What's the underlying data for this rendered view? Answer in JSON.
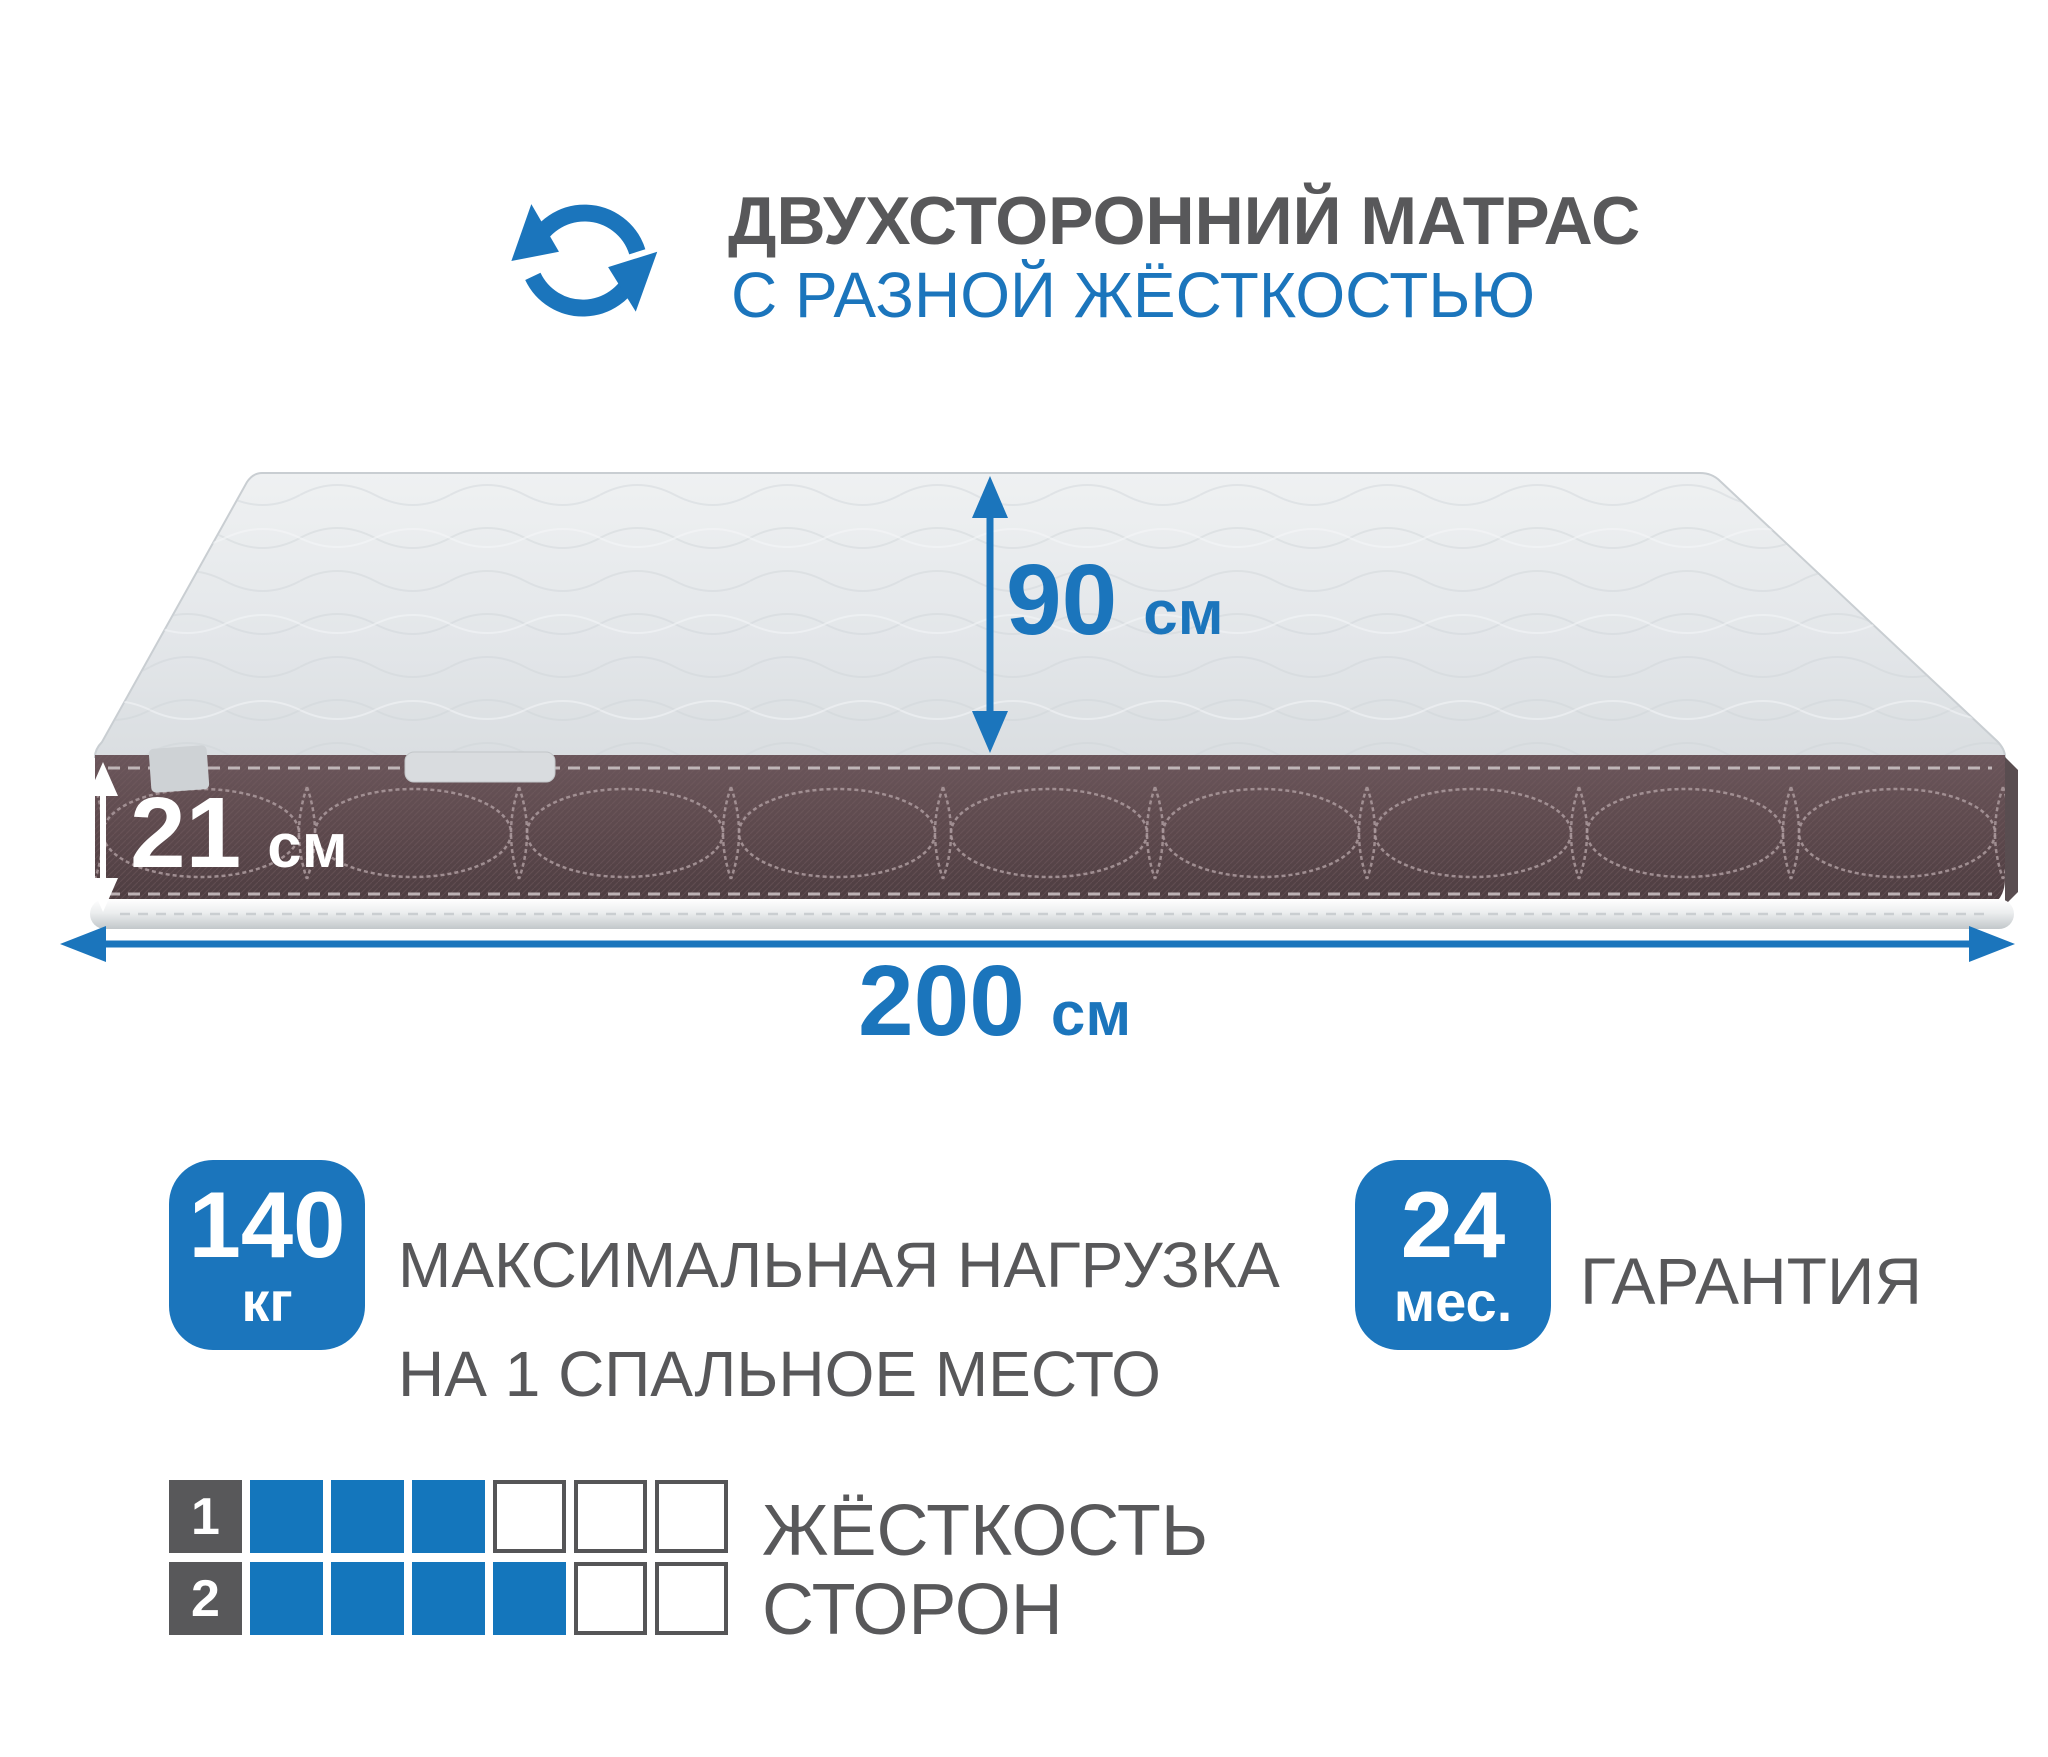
{
  "page": {
    "background": "#ffffff"
  },
  "colors": {
    "accent_blue": "#1b75bc",
    "text_gray": "#58585a",
    "band_brown": "#5e4a4e",
    "top_surface": "#e4e7ea"
  },
  "header": {
    "icon": "rotate-arrows-icon",
    "title": "ДВУХСТОРОННИЙ МАТРАС",
    "subtitle": "С РАЗНОЙ ЖЁСТКОСТЬЮ"
  },
  "mattress_dimensions": {
    "depth": {
      "value": "90",
      "unit": "см"
    },
    "height": {
      "value": "21",
      "unit": "см"
    },
    "length": {
      "value": "200",
      "unit": "см"
    }
  },
  "max_load": {
    "value": "140",
    "unit": "кг",
    "label_line1": "МАКСИМАЛЬНАЯ НАГРУЗКА",
    "label_line2": "НА 1 СПАЛЬНОЕ МЕСТО"
  },
  "warranty": {
    "value": "24",
    "unit": "мес.",
    "label": "ГАРАНТИЯ"
  },
  "firmness": {
    "caption_line1": "ЖЁСТКОСТЬ",
    "caption_line2": "СТОРОН",
    "scale_max": 6,
    "rows": [
      {
        "label": "1",
        "filled": 3
      },
      {
        "label": "2",
        "filled": 4
      }
    ]
  }
}
